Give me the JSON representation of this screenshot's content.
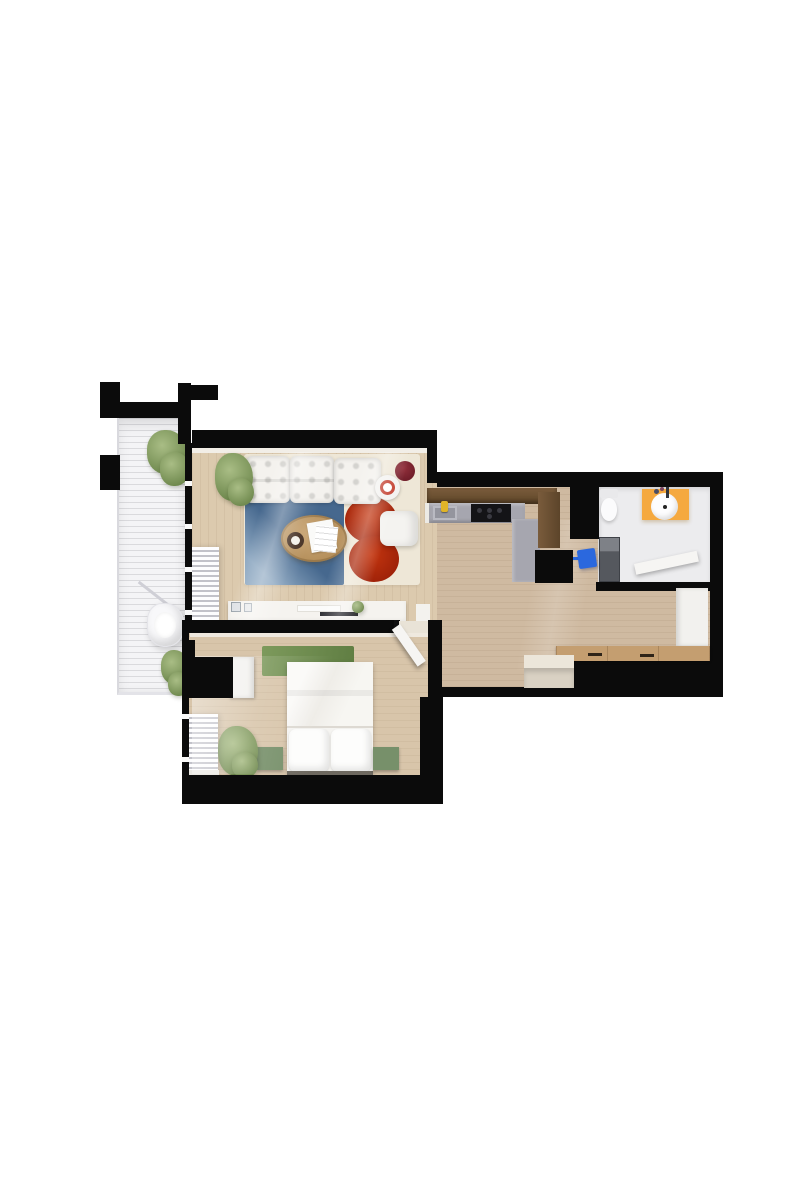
{
  "scene": {
    "type": "3d-floor-plan-render",
    "view": "top-down",
    "description": "Top-down 3D render of a one-bedroom apartment floor plan on a white background"
  },
  "palette": {
    "bg": "#ffffff",
    "wall": "#0b0b0b",
    "floor-living": "#dccaae",
    "floor-open": "#cfbaa1",
    "floor-bedroom": "#d8c5aa",
    "balcony-deck": "#f4f4f6",
    "rug-ivory": "#eee7d7",
    "rug-blue": "#46688e",
    "rug-blue-light": "#8fa9c2",
    "rug-red": "#b22a10",
    "rug-green": "#6f8c50",
    "sofa-white": "#f4f2ee",
    "table-wood": "#c19b67",
    "side-table-red": "#7d2130",
    "ring-red": "#c23b2b",
    "counter-gray": "#a6a6af",
    "cabinet-wood": "#6d5134",
    "cabinet-dark": "#57412a",
    "cooktop": "#141417",
    "faucet-yellow": "#e0b428",
    "vanity-orange": "#f5a93f",
    "towel-blue": "#2b68de",
    "appliance-gray": "#55585e",
    "bench-wood": "#c49e70",
    "bench-green": "#77906a",
    "plant-dark": "#708a4f",
    "plant-light": "#a9bd85",
    "door-white": "#f6f5f3"
  },
  "rooms": {
    "living": {
      "name": "Living room",
      "furniture": [
        "white tufted sofa",
        "ivory rug",
        "blue rug",
        "red shag rug",
        "oval wood coffee table",
        "white armchair",
        "white side table with red ring",
        "dark red side table",
        "potted plant",
        "window curtain",
        "white sideboard"
      ]
    },
    "kitchen": {
      "name": "Kitchen",
      "furniture": [
        "L-shaped counter",
        "sink with yellow faucet",
        "black cooktop",
        "dark wood cabinets",
        "tall cabinet"
      ]
    },
    "bathroom": {
      "name": "Bathroom",
      "furniture": [
        "wall-hung toilet",
        "orange vanity with round sink",
        "washer",
        "blue towel",
        "open door"
      ]
    },
    "hallway": {
      "name": "Hallway",
      "furniture": [
        "wooden bench",
        "entry step",
        "white wall panel"
      ]
    },
    "bedroom": {
      "name": "Bedroom",
      "furniture": [
        "double bed with white bedding",
        "green rug",
        "two sage green benches",
        "wardrobe",
        "potted plant",
        "radiator",
        "open door"
      ]
    },
    "balcony": {
      "name": "Balcony",
      "furniture": [
        "white slatted deck",
        "hanging chair",
        "two potted plants"
      ]
    }
  }
}
